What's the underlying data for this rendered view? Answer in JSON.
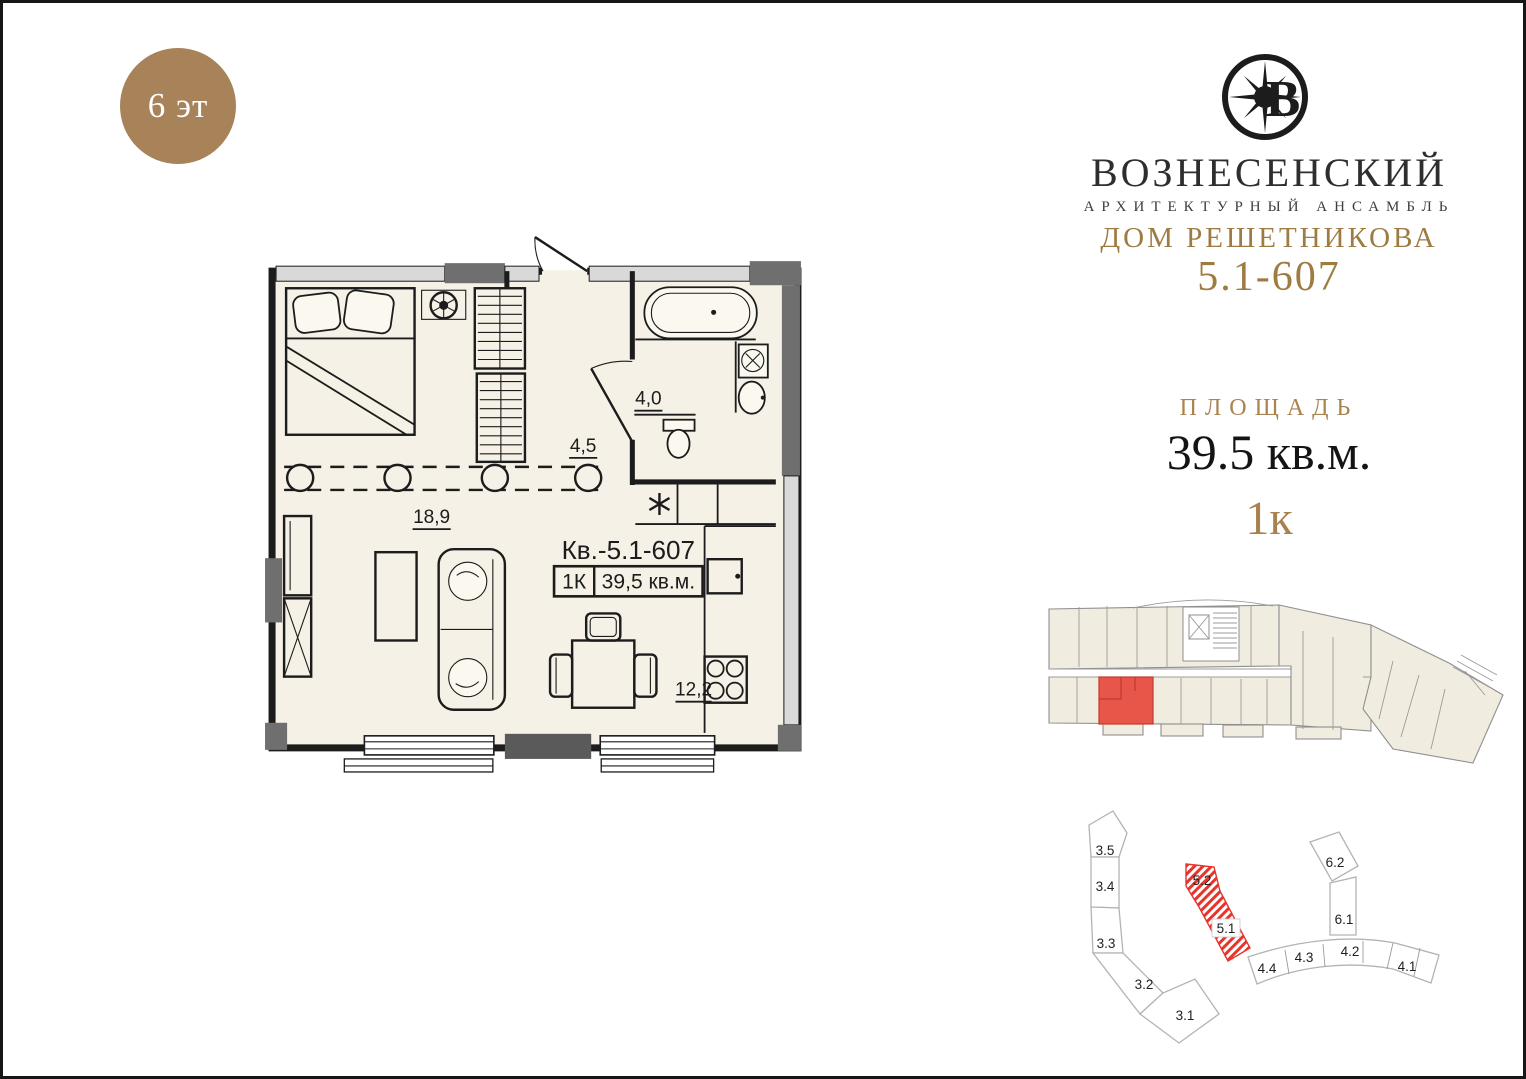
{
  "page": {
    "background": "#ffffff",
    "frame_color": "#161616"
  },
  "floor_badge": {
    "label": "6 эт",
    "bg_color": "#a88258",
    "text_color": "#ffffff"
  },
  "brand": {
    "logo_icon": "compass-star-monogram",
    "name": "ВОЗНЕСЕНСКИЙ",
    "tagline": "АРХИТЕКТУРНЫЙ АНСАМБЛЬ",
    "building": "ДОМ РЕШЕТНИКОВА",
    "unit_code": "5.1-607",
    "gold_color": "#9e7b41",
    "dark_color": "#2e2e2e"
  },
  "area_info": {
    "label": "ПЛОЩАДЬ",
    "value": "39.5 кв.м.",
    "rooms": "1к"
  },
  "floor_plan": {
    "apartment_label": "Кв.-5.1-607",
    "type_label": "1К",
    "area_label": "39,5 кв.м.",
    "living_area": "18,9",
    "hall_area": "4,5",
    "bath_area": "4,0",
    "kitchen_area": "12,2"
  },
  "floor_overview": {
    "highlight_color": "#e8564a"
  },
  "site_plan": {
    "sections": [
      "3.5",
      "3.4",
      "3.3",
      "3.2",
      "3.1",
      "5.2",
      "5.1",
      "4.4",
      "4.3",
      "4.2",
      "4.1",
      "6.2",
      "6.1"
    ],
    "highlight_color": "#e8352b"
  }
}
